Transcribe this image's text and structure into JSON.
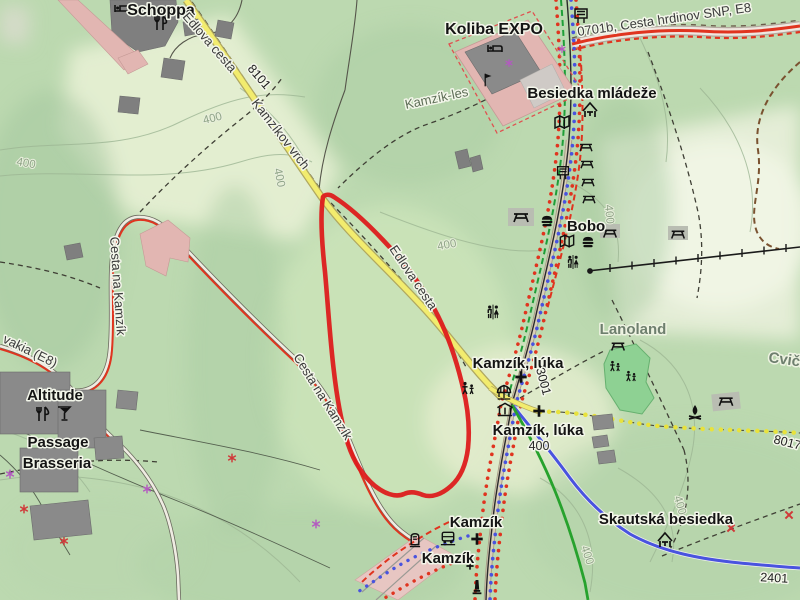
{
  "map": {
    "poi_labels": {
      "schoppa": "Schoppa",
      "koliba_expo": "Koliba EXPO",
      "besiedka_mladeze": "Besiedka mládeže",
      "bobo": "Bobo",
      "kamzik_luka": "Kamzík, lúka",
      "kamzik_stop": "Kamzík",
      "skautska_besiedka": "Skautská besiedka",
      "altitude": "Altitude",
      "passage": "Passage",
      "brasseria": "Brasseria"
    },
    "area_labels": {
      "lanoland": "Lanoland",
      "kamzik_les": "Kamzík-les",
      "cvicna_partial": "Cvičn"
    },
    "road_labels": {
      "edlova_cesta": "Edlova cesta",
      "cesta_na_kamzik": "Cesta na Kamzík",
      "kamzikov_vrch": "Kamzíkov vrch",
      "slovakia_e8_partial": "vakia (E8)",
      "cesta_hrdinov_snp": "0701b, Cesta hrdinov SNP, E8"
    },
    "route_numbers": {
      "r8101": "8101",
      "r3001": "3001",
      "r2401": "2401",
      "r8017": "8017"
    },
    "elevations": {
      "contour": "400",
      "kamzik_luka_elev": "400"
    },
    "colors": {
      "highlight_polygon": "#dd1c1c",
      "hiking_red": "#e0341f",
      "cycling_blue": "#4953df",
      "route_green": "#27a22d",
      "trail_yellow": "#e8e23c",
      "road_yellow": "#f2ec6e",
      "forest_green": "#bcd9b0",
      "meadow_light": "#edf2d8",
      "building_gray": "#7f7f7f",
      "building_pink": "#e2b6b2",
      "contour_gray": "#9db694"
    },
    "icons": [
      "bed-icon",
      "restaurant-icon",
      "bar-icon",
      "flag-icon",
      "guidepost-icon",
      "map-board-icon",
      "shelter-icon",
      "picnic-table-icon",
      "fast-food-icon",
      "toilets-icon",
      "playground-icon",
      "carousel-icon",
      "gazebo-icon",
      "cross-icon",
      "bus-icon",
      "ticket-machine-icon",
      "monument-icon",
      "campfire-icon",
      "power-pylon-icon",
      "chairlift-icon"
    ]
  }
}
